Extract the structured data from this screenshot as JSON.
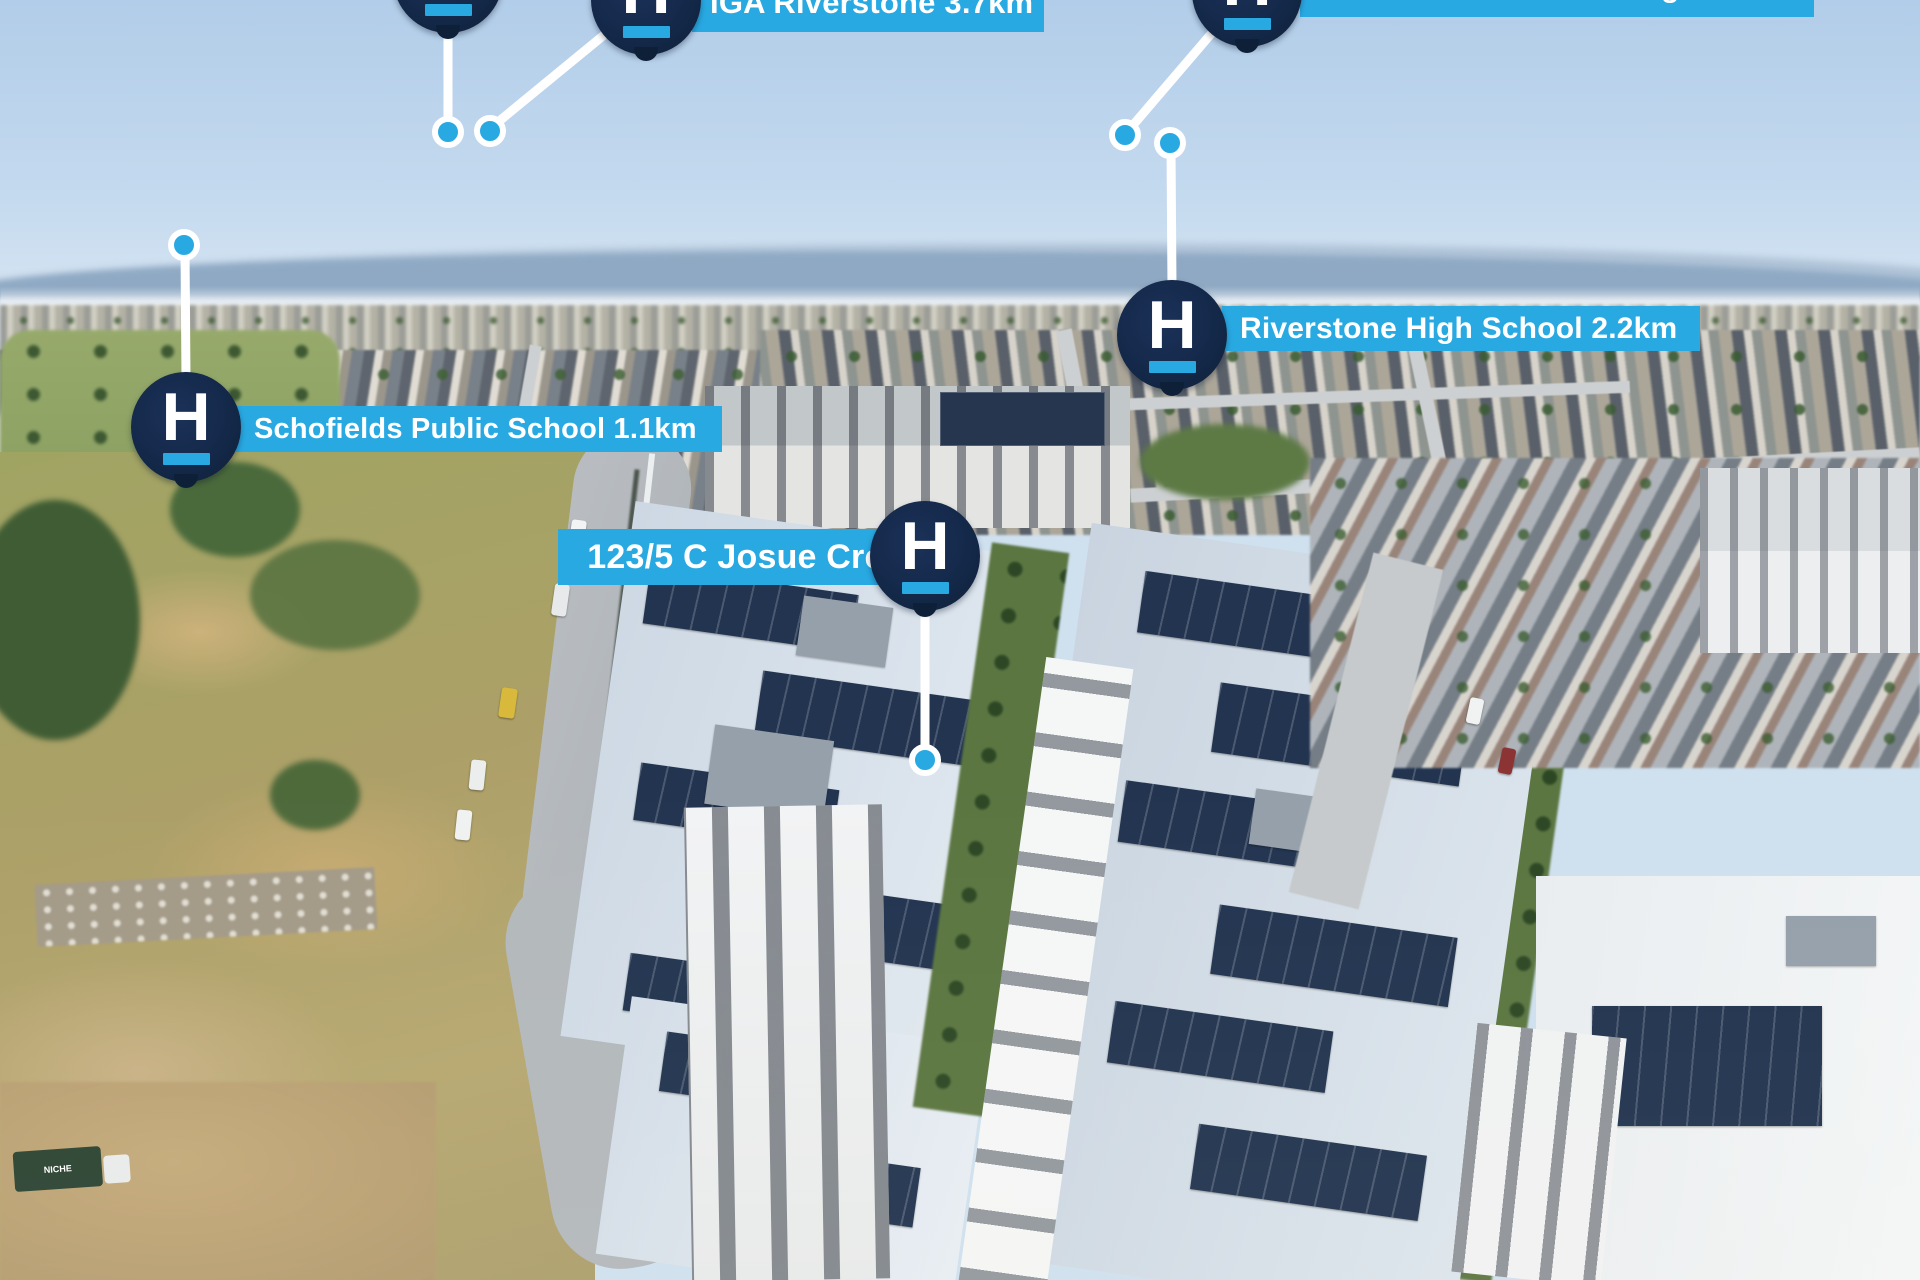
{
  "brand": {
    "letter": "H",
    "navy": "#14294A",
    "blue": "#29A9E2",
    "label_text_color": "#FFFFFF"
  },
  "markers": {
    "top_partial": {
      "label": ""
    },
    "iga": {
      "label": "IGA Riverstone 3.7km"
    },
    "norwest": {
      "label": "Norwest Christian College 2.6km"
    },
    "riverstone_high": {
      "label": "Riverstone High School 2.2km"
    },
    "schofields": {
      "label": "Schofields Public School 1.1km"
    },
    "property": {
      "label": "123/5 C Josue Cres"
    }
  },
  "scene": {
    "description": "aerial drone photo of Schofields/Riverstone suburb with apartment complex in foreground",
    "truck_text": "NICHE"
  }
}
